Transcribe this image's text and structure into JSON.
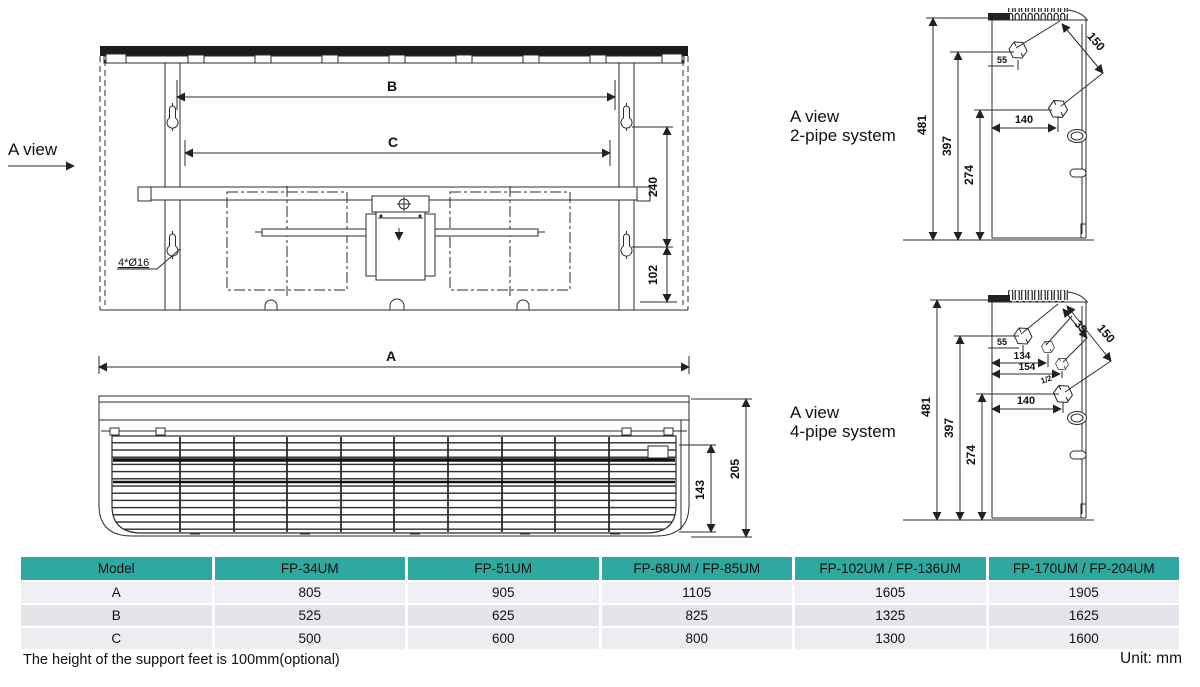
{
  "page": {
    "footnote": "The height of the support feet is 100mm(optional)",
    "unit_label": "Unit: mm"
  },
  "back_view": {
    "view_label": "A view",
    "hole_callout": "4*Ø16",
    "dim_b": "B",
    "dim_c": "C",
    "dim_240": "240",
    "dim_102": "102"
  },
  "front_view": {
    "dim_a": "A",
    "dim_205": "205",
    "dim_143": "143"
  },
  "pipe_2": {
    "title1": "A view",
    "title2": "2-pipe system",
    "d481": "481",
    "d397": "397",
    "d274": "274",
    "d140": "140",
    "d150": "150",
    "d55": "55"
  },
  "pipe_4": {
    "title1": "A view",
    "title2": "4-pipe system",
    "d481": "481",
    "d397": "397",
    "d274": "274",
    "d140": "140",
    "d150": "150",
    "d55": "55",
    "d134": "134",
    "d154": "154",
    "d35": "35",
    "d_half": "1/2"
  },
  "table": {
    "header": [
      "Model",
      "FP-34UM",
      "FP-51UM",
      "FP-68UM / FP-85UM",
      "FP-102UM / FP-136UM",
      "FP-170UM / FP-204UM"
    ],
    "rows": [
      {
        "label": "A",
        "values": [
          "805",
          "905",
          "1105",
          "1605",
          "1905"
        ]
      },
      {
        "label": "B",
        "values": [
          "525",
          "625",
          "825",
          "1325",
          "1625"
        ]
      },
      {
        "label": "C",
        "values": [
          "500",
          "600",
          "800",
          "1300",
          "1600"
        ]
      }
    ],
    "colors": {
      "header_bg": "#2fa8a0",
      "row_a_bg": "#eef0f4",
      "row_b_bg": "#e3e5e9",
      "row_c_bg": "#ebedf1",
      "line": "#2b2b2b"
    }
  }
}
